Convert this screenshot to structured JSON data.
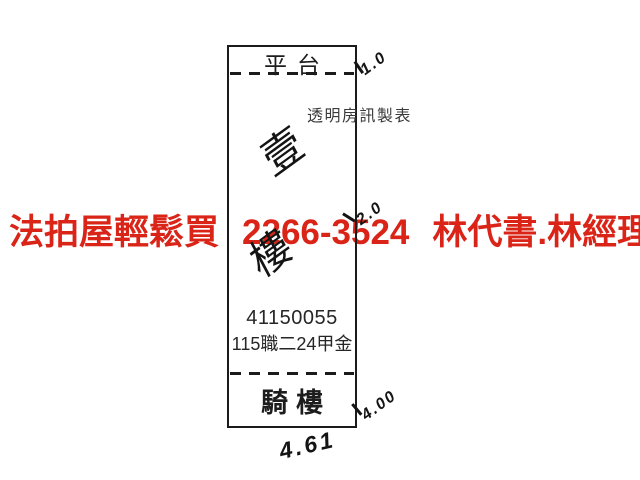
{
  "plan": {
    "platform_label": "平台",
    "arcade_label": "騎樓",
    "watermark": "透明房訊製表",
    "registration_number": "41150055",
    "lot_label": "115職二24甲金",
    "handwritten_floor_note": {
      "char_top": "壹",
      "char_bottom": "樓"
    },
    "dimensions": {
      "top_right": "1.0",
      "middle_right": "2.0",
      "bottom_right": "4.00",
      "bottom_width": "4.61"
    },
    "ink_color": "#1b1b1b"
  },
  "ad_overlay": {
    "slogan": "法拍屋輕鬆買",
    "phone": "2266-3524",
    "contact": "林代書.林經理",
    "color": "#da2418"
  }
}
